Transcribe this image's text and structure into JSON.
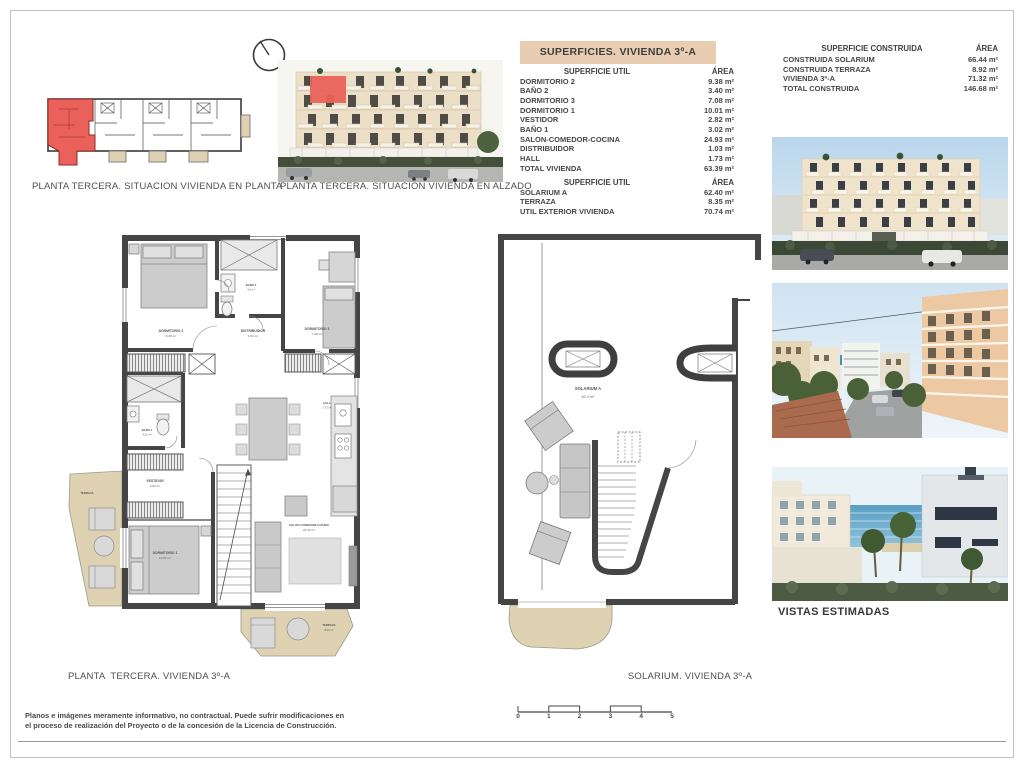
{
  "sheet": {
    "captions": {
      "plan_situation": "PLANTA TERCERA. SITUACION VIVIENDA EN PLANTA",
      "elevation_situation": "PLANTA TERCERA. SITUACION VIVIENDA EN ALZADO",
      "floor_plan": "PLANTA  TERCERA. VIVIENDA 3º-A",
      "solarium_plan": "SOLARIUM. VIVIENDA 3º-A",
      "views": "VISTAS ESTIMADAS"
    },
    "disclaimer": {
      "line1": "Planos e imágenes meramente informativo, no contractual. Puede sufrir modificaciones en",
      "line2": "el proceso de realización del Proyecto o de la concesión de la Licencia de Construcción."
    }
  },
  "superficies_table": {
    "title": "SUPERFICIES. VIVIENDA 3º-A",
    "sections": [
      {
        "header": {
          "label": "SUPERFICIE UTIL",
          "area": "ÁREA"
        },
        "rows": [
          {
            "label": "DORMITORIO 2",
            "area": "9.38 m²"
          },
          {
            "label": "BAÑO 2",
            "area": "3.40 m²"
          },
          {
            "label": "DORMITORIO 3",
            "area": "7.08 m²"
          },
          {
            "label": "DORMITORIO 1",
            "area": "10.01 m²"
          },
          {
            "label": "VESTIDOR",
            "area": "2.82 m²"
          },
          {
            "label": "BAÑO 1",
            "area": "3.02 m²"
          },
          {
            "label": "SALON-COMEDOR-COCINA",
            "area": "24.93 m²"
          },
          {
            "label": "DISTRIBUIDOR",
            "area": "1.03 m²"
          },
          {
            "label": "HALL",
            "area": "1.73 m²"
          },
          {
            "label": "TOTAL VIVIENDA",
            "area": "63.39 m²"
          }
        ]
      },
      {
        "header": {
          "label": "SUPERFICIE UTIL",
          "area": "ÁREA"
        },
        "rows": [
          {
            "label": "SOLARIUM A",
            "area": "62.40 m²"
          },
          {
            "label": "TERRAZA",
            "area": "8.35 m²"
          },
          {
            "label": "UTIL EXTERIOR VIVIENDA",
            "area": "70.74 m²"
          }
        ]
      }
    ]
  },
  "construida_table": {
    "header": {
      "label": "SUPERFICIE CONSTRUIDA",
      "area": "ÁREA"
    },
    "rows": [
      {
        "label": "CONSTRUIDA SOLARIUM",
        "area": "66.44 m²"
      },
      {
        "label": "CONSTRUIDA TERRAZA",
        "area": "8.92 m²"
      },
      {
        "label": "VIVIENDA 3º-A",
        "area": "71.32 m²"
      },
      {
        "label": "TOTAL CONSTRUIDA",
        "area": "146.68 m²"
      }
    ]
  },
  "floor_plan_labels": {
    "dormitorio2": {
      "name": "DORMITORIO 2",
      "area": "9.38 m²"
    },
    "bano2": {
      "name": "BAÑO 2",
      "area": "3.4 m²"
    },
    "dormitorio3": {
      "name": "DORMITORIO 3",
      "area": "7.08 m²"
    },
    "distribuidor": {
      "name": "DISTRIBUIDOR",
      "area": "1.03 m²"
    },
    "hall": {
      "name": "HALL",
      "area": "1.73 m²"
    },
    "bano1": {
      "name": "BAÑO 1",
      "area": "3.02 m²"
    },
    "vestidor": {
      "name": "VESTIDOR",
      "area": "2.82 m²"
    },
    "dormitorio1": {
      "name": "DORMITORIO 1",
      "area": "10.01 m²"
    },
    "salon": {
      "name": "SALON-COMEDOR-COCINA",
      "area": "24.93 m²"
    },
    "terraza_left": {
      "name": "TERRAZA"
    },
    "terraza_bottom": {
      "name": "TERRAZA",
      "area": "8.35 m²"
    }
  },
  "solarium_labels": {
    "solarium": {
      "name": "SOLARIUM A",
      "area": "62.4 m²"
    }
  },
  "scale_bar": {
    "ticks": [
      "0",
      "1",
      "2",
      "3",
      "4",
      "5"
    ]
  },
  "colors": {
    "table_header_bg": "#e8cdb2",
    "highlight_red": "#e9615a",
    "terrace_tan": "#ded2b2",
    "wall_dark": "#454545"
  }
}
